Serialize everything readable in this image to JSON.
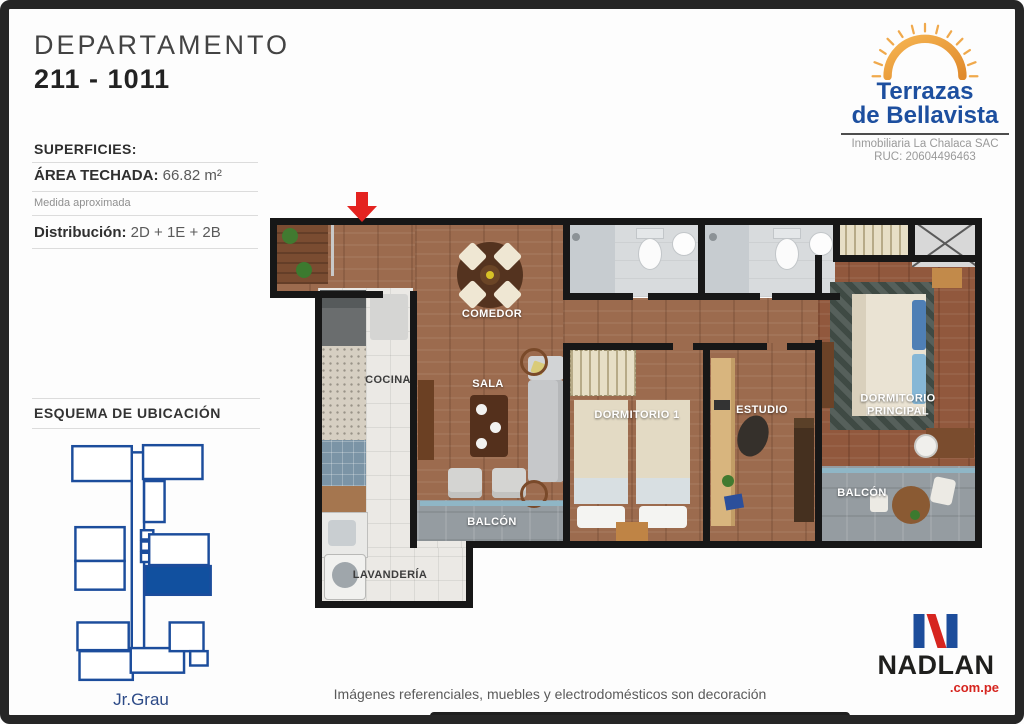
{
  "header": {
    "title": "DEPARTAMENTO",
    "unit": "211 - 1011"
  },
  "specs": {
    "section_title": "SUPERFICIES:",
    "area_label": "ÁREA TECHADA:",
    "area_value": "66.82 m²",
    "note": "Medida aproximada",
    "distribution_label": "Distribución:",
    "distribution_value": "2D + 1E + 2B"
  },
  "location_scheme": {
    "title": "ESQUEMA DE UBICACIÓN",
    "street": "Jr.Grau"
  },
  "developer": {
    "brand_line1": "Terrazas",
    "brand_line2": "de Bellavista",
    "company": "Inmobiliaria La Chalaca SAC",
    "ruc": "RUC: 20604496463"
  },
  "floorplan": {
    "labels": {
      "comedor": "COMEDOR",
      "cocina": "COCINA",
      "sala": "SALA",
      "dormitorio1": "DORMITORIO 1",
      "estudio": "ESTUDIO",
      "dormitorio_principal": "DORMITORIO PRINCIPAL",
      "balcon_izq": "BALCÓN",
      "balcon_der": "BALCÓN",
      "lavanderia": "LAVANDERÍA"
    }
  },
  "footer": {
    "disclaimer": "Imágenes referenciales, muebles y electrodomésticos son decoración"
  },
  "agency": {
    "name": "NADLAN",
    "domain": ".com.pe"
  },
  "colors": {
    "brand_blue": "#1d4f9f",
    "schematic_blue": "#1c4d9c",
    "highlight_blue": "#11509f",
    "entrance_red": "#e42320",
    "nadlan_blue": "#1d4d9b",
    "nadlan_red": "#d6251f",
    "wall": "#171717"
  }
}
